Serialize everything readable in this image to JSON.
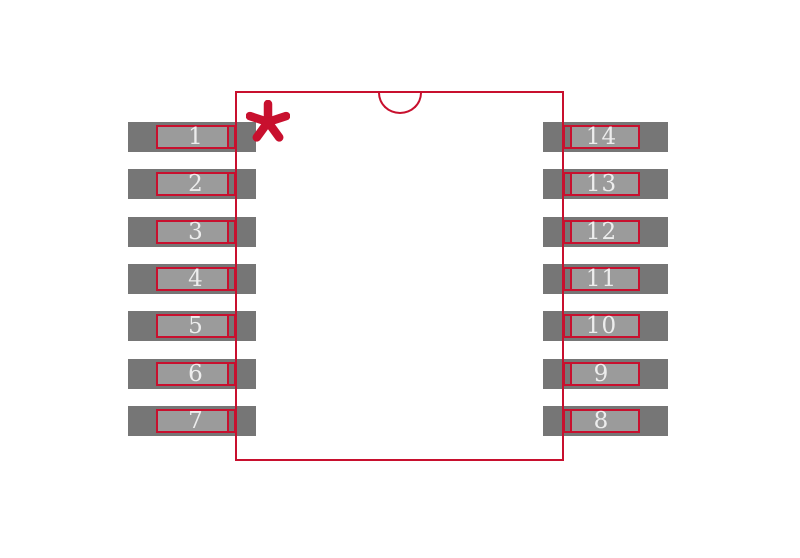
{
  "canvas": {
    "background": "#FFFFFF"
  },
  "colors": {
    "canvas_bg": "#FFFFFF",
    "outline": "#C8102E",
    "pad_copper": "#767676",
    "pad_inner": "#9B9B9B",
    "pin_number_text": "#EDEDED"
  },
  "marker": {
    "name": "pin1-asterisk",
    "symbol": "✱"
  },
  "pins": {
    "left": [
      {
        "number": "1"
      },
      {
        "number": "2"
      },
      {
        "number": "3"
      },
      {
        "number": "4"
      },
      {
        "number": "5"
      },
      {
        "number": "6"
      },
      {
        "number": "7"
      }
    ],
    "right": [
      {
        "number": "14"
      },
      {
        "number": "13"
      },
      {
        "number": "12"
      },
      {
        "number": "11"
      },
      {
        "number": "10"
      },
      {
        "number": "9"
      },
      {
        "number": "8"
      }
    ]
  }
}
